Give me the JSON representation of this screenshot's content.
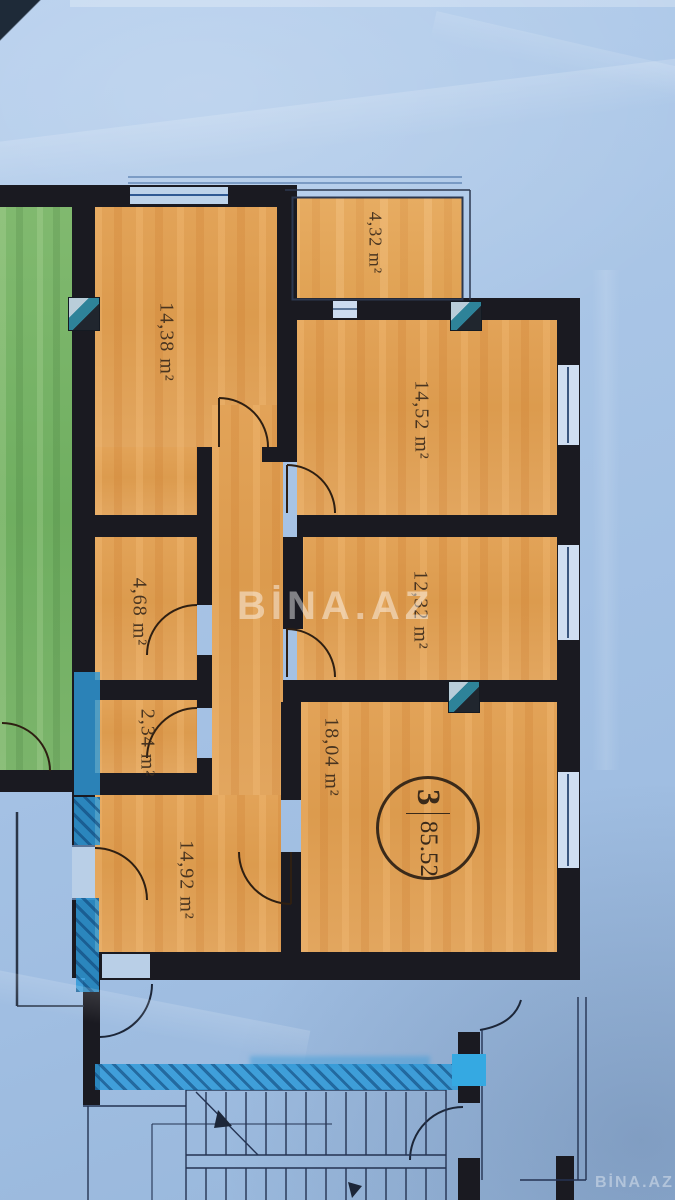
{
  "plan": {
    "rooms": [
      {
        "id": "balcony",
        "area_label": "4,32 m²"
      },
      {
        "id": "room-a",
        "area_label": "14,38 m²"
      },
      {
        "id": "room-b",
        "area_label": "14,52 m²"
      },
      {
        "id": "room-c",
        "area_label": "12,32 m²"
      },
      {
        "id": "hall",
        "area_label": "4,68 m²"
      },
      {
        "id": "wc",
        "area_label": "2,34 m²"
      },
      {
        "id": "room-d",
        "area_label": "18,04 m²"
      },
      {
        "id": "room-e",
        "area_label": "14,92 m²"
      }
    ],
    "unit_badge": {
      "rooms_count": "3",
      "total_area": "85.52"
    },
    "watermarks": {
      "center": "BİNA.AZ",
      "corner": "BİNA.AZ"
    },
    "icons": {
      "vent_marker": "diagonal-split-square",
      "stair_arrow": "solid-triangle"
    },
    "colors": {
      "paper_blue": "#a9c5e6",
      "room_orange": "#e0a156",
      "neighbor_green": "#7cb76b",
      "wall_black": "#1a1a21",
      "marker_blue": "#2f9ad8",
      "drawing_line_blue": "#243352",
      "label_brown": "#3d2c1c",
      "watermark_white": "rgba(255,255,255,0.45)"
    }
  }
}
